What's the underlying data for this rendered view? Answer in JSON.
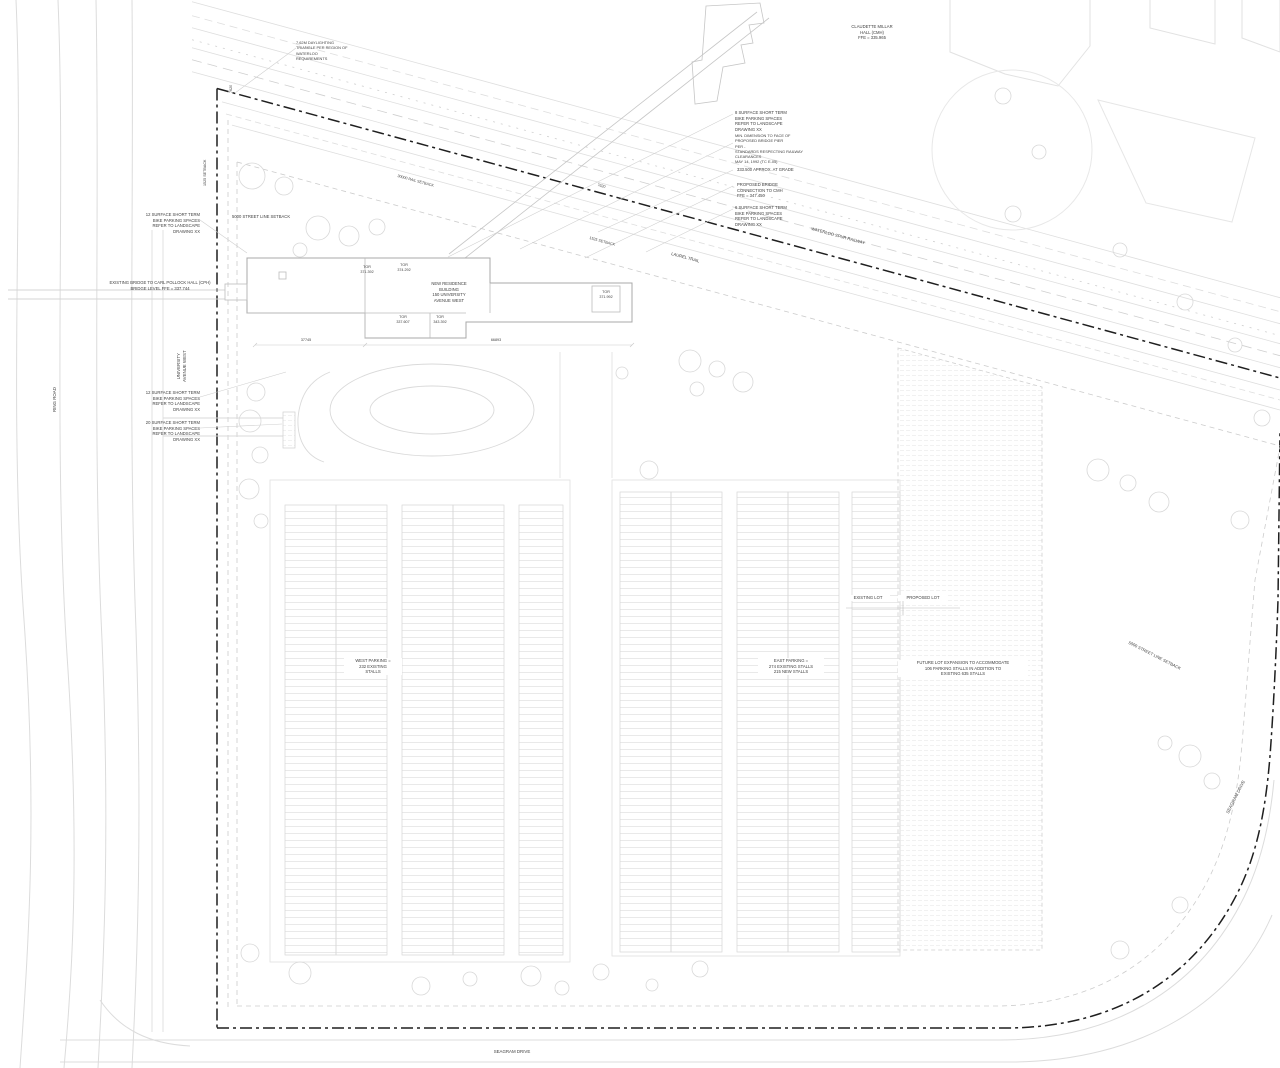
{
  "drawing": {
    "buildings": {
      "cmh": "CLAUDETTE MILLAR\nHALL (CMH)\nFFE = 335.965",
      "new_residence": "NEW RESIDENCE\nBUILDING\n150 UNIVERSITY\nAVENUE WEST",
      "cph_bridge": "EXISTING BRIDGE TO CARL POLLOCK HALL (CPH)\nBRIDGE LEVEL FFE = 337.744"
    },
    "tor": {
      "a": "TOR\n371.392",
      "b": "TOR\n374.292",
      "c": "TOR\n371.992",
      "d": "TOR\n337.607",
      "e": "TOR\n343.392"
    },
    "annotations": {
      "daylight_triangle": "7.62M DAYLIGHTING\nTRIANGLE PER REGION OF\nWATERLOO\nREQUIREMENTS",
      "bike_8": "8 SURFACE SHORT TERM\nBIKE PARKING SPACES\nREFER TO LANDSCAPE\nDRAWING XX",
      "min_dimension": "MIN. DIMENSION TO FACE OF\nPROPOSED BRIDGE PIER\nPER -\nSTANDARDS RESPECTING RAILWAY\nCLEARANCES\nMAY 14, 1992 (TC E-05)",
      "at_grade": "333.500 APPROX. AT GRADE",
      "bridge_connection": "PROPOSED BRIDGE\nCONNECTION TO CMH\nFFE = 347.450",
      "bike_6": "6 SURFACE SHORT TERM\nBIKE PARKING SPACES\nREFER TO LANDSCAPE\nDRAWING XX",
      "bike_12_north": "12 SURFACE SHORT TERM\nBIKE PARKING SPACES\nREFER TO LANDSCAPE\nDRAWING XX",
      "bike_12_west": "12 SURFACE SHORT TERM\nBIKE PARKING SPACES\nREFER TO LANDSCAPE\nDRAWING XX",
      "bike_20_west": "20 SURFACE SHORT TERM\nBIKE PARKING SPACES\nREFER TO LANDSCAPE\nDRAWING XX"
    },
    "setbacks": {
      "street_line": "5000 STREET LINE SETBACK",
      "rail": "30000 RAIL SETBACK",
      "s1525": "1525 SETBACK",
      "d7620": "7620"
    },
    "dimensions": {
      "building_west": "37745",
      "building_east": "66893"
    },
    "parking": {
      "west": "WEST PARKING =\n232 EXISTING\nSTALLS",
      "east": "EAST PARKING =\n274 EXISTING STALLS\n215 NEW STALLS",
      "future": "FUTURE LOT EXPANSION TO ACCOMMODATE\n106 PARKING STALLS IN ADDITION TO\nEXISTING 635 STALLS",
      "existing_lot": "EXISTING LOT",
      "proposed_lot": "PROPOSED LOT"
    },
    "streets": {
      "university_ave": "UNIVERSITY\nAVENUE WEST",
      "ring_road": "RING ROAD",
      "seagram": "SEAGRAM DRIVE",
      "laurel_trail": "LAUREL TRAIL",
      "waterloo_spur": "WATERLOO SPUR RAILWAY"
    },
    "colors": {
      "paper": "#ffffff",
      "line_light": "#dcdcdc",
      "line_mid": "#c2c2c2",
      "property_line": "#1f1f1f",
      "text": "#3f3f3f"
    }
  }
}
